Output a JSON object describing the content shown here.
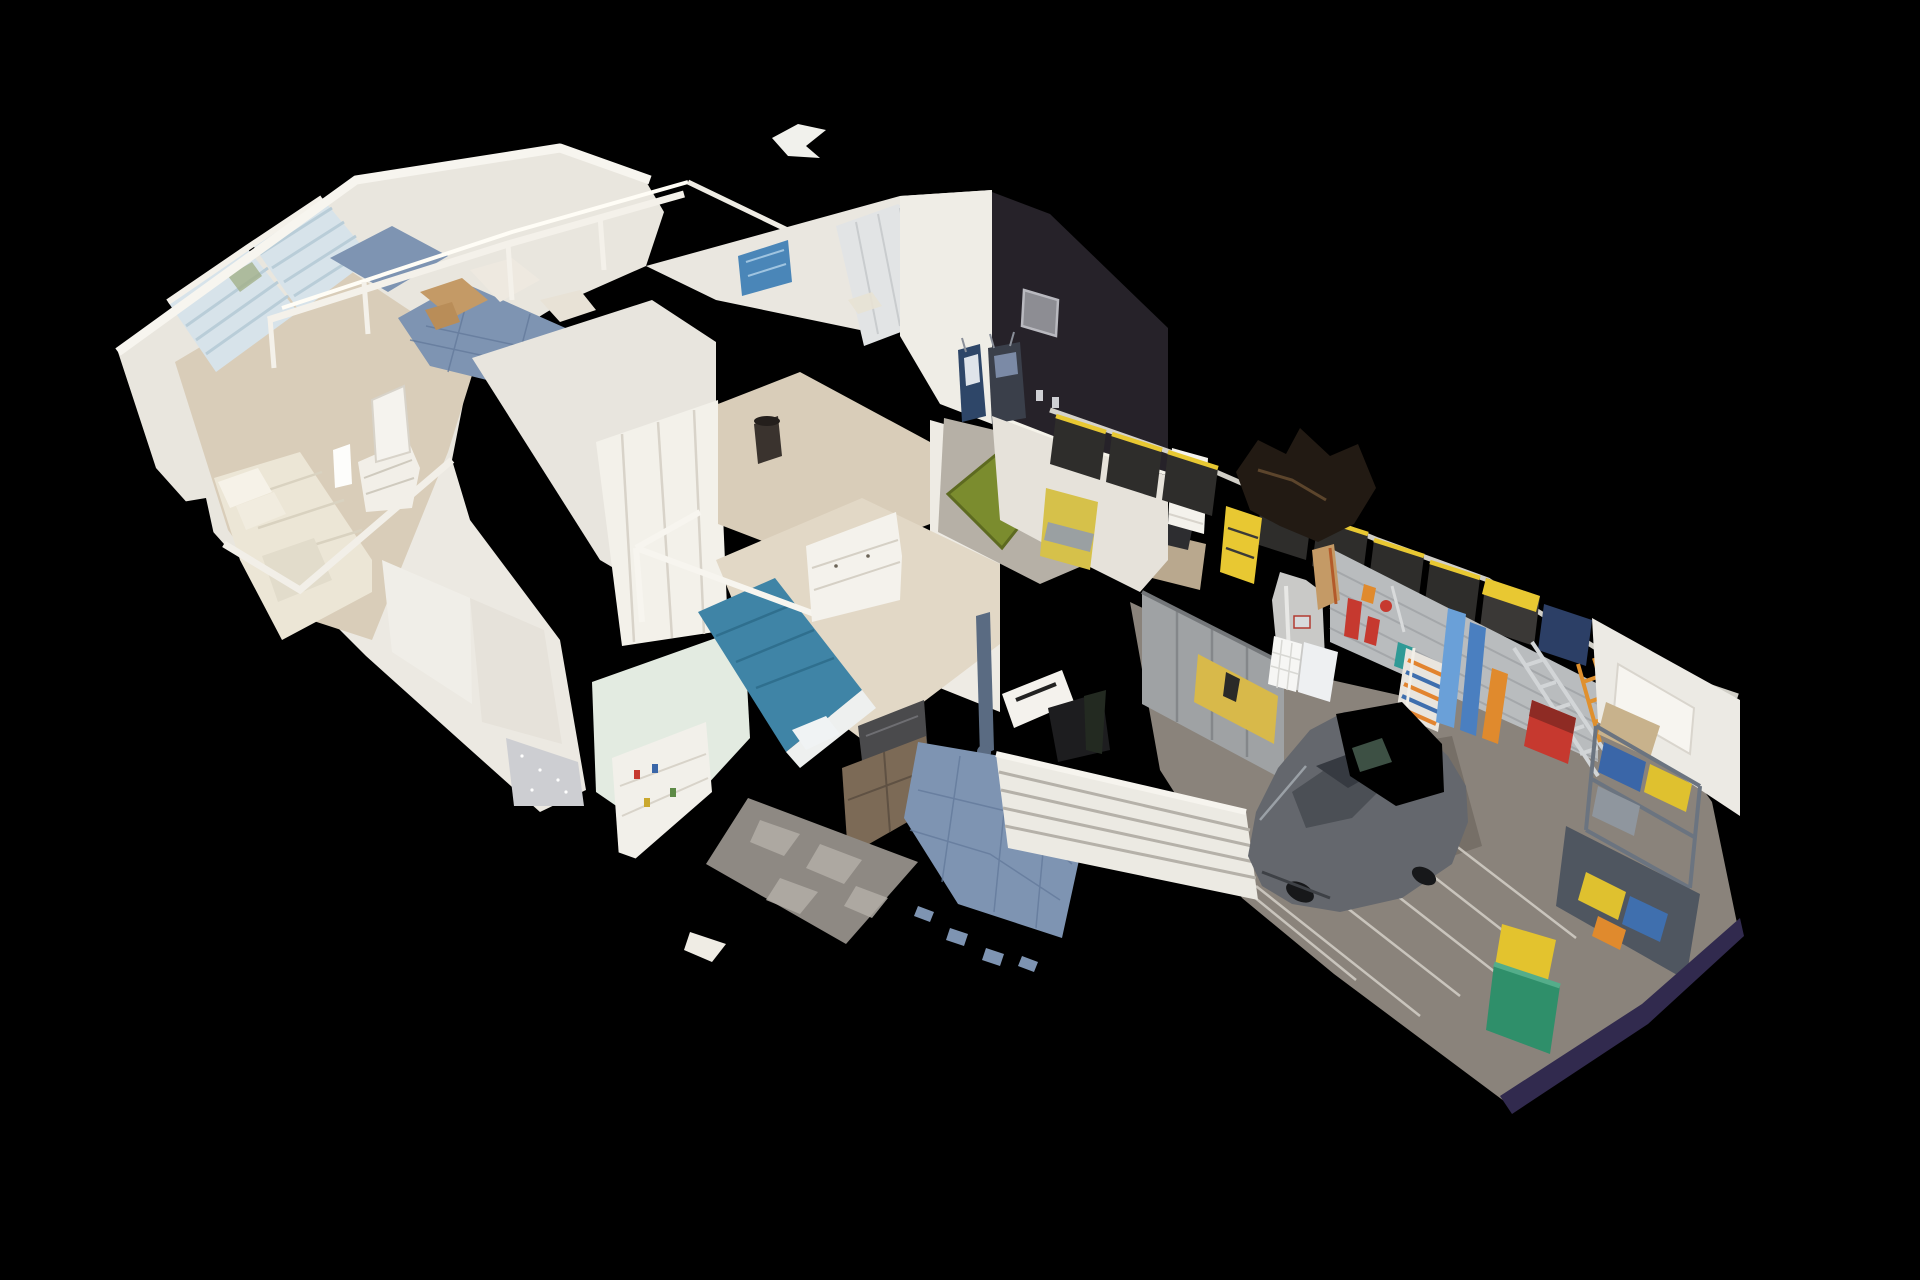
{
  "scene": {
    "app": "3d-home-tour-viewer",
    "view_mode": "dollhouse-cutaway",
    "background": "#000000",
    "description": "Elevated oblique dollhouse view of a scanned single-story home floating on black. Left wing: master bedroom with cream bed, plantation-shutter window wall, white dresser and arched niche. Between wings: blue slate patio with white fence rails and floating scan fragments. Center: tall cut ivory walls, closet doors, hallway with trash can, guest bedroom with teal bed under a white canopy frame, white dresser, TV over a wood cabinet, white bookshelf and mottled grey rug. Upper right: golf room with near-black accent wall, lit picture, two golf bags, grey carpet and green putting mat. Right: garage with grey concrete floor, grey sedan missing its roof (black scan hole), silver cabinets with yellow workbench, water heater, laundry hamper, slat tool wall with red/orange/teal tools, ladders, skis, striped folding chairs, black-and-yellow overhead storage bins, shelving, yellow cart, green trash bin, striped garage-door wall and a dark purple cut edge.",
    "rooms": [
      {
        "name": "master-bedroom",
        "items": [
          "cream bed",
          "plantation shutter windows",
          "white dresser",
          "arched niche",
          "air purifier",
          "wood floor",
          "scan hole"
        ]
      },
      {
        "name": "master-bathroom",
        "items": [
          "blue slate tile strip",
          "glitter tile floor"
        ]
      },
      {
        "name": "patio-courtyard",
        "items": [
          "blue slate tiles",
          "white fence rails",
          "tan scan fragments"
        ]
      },
      {
        "name": "hallway",
        "items": [
          "closet double doors",
          "dark trash can",
          "blue wall art",
          "wood floor"
        ]
      },
      {
        "name": "guest-bedroom",
        "items": [
          "teal bed",
          "white canopy frame",
          "white dresser",
          "tv",
          "wood cabinet",
          "white bookshelf",
          "grey rug",
          "sage cut wall",
          "scan holes"
        ]
      },
      {
        "name": "golf-room",
        "items": [
          "dark accent wall",
          "lit picture frame",
          "outlets",
          "golf bag navy",
          "golf bag black",
          "green putting mat",
          "grey carpet",
          "desk",
          "louvered door",
          "window"
        ]
      },
      {
        "name": "garage",
        "items": [
          "grey sedan",
          "black roof hole",
          "concrete floor",
          "tire streaks",
          "garage door slats",
          "silver cabinets",
          "yellow workbench",
          "water heater",
          "laundry hamper",
          "trash bag",
          "slat tool wall",
          "red tools",
          "teal tools",
          "striped folding chairs",
          "blue boards",
          "orange skis",
          "silver ladder",
          "orange ladder",
          "red generator",
          "overhead black-yellow bins",
          "yellow pressure washer",
          "shop vacuum",
          "ceiling scan blob",
          "electrical door",
          "storage shelving",
          "cardboard boxes",
          "yellow cart",
          "green trash bin",
          "purple cut edge",
          "slate walkway"
        ]
      }
    ],
    "palette": {
      "background": "#000000",
      "wall_ivory": "#e9e6de",
      "wall_bright": "#f7f5ef",
      "wood_floor": "#d9cdb9",
      "wood_floor_light": "#e2d8c6",
      "slate_tile": "#7e94b2",
      "slate_tile_dark": "#5f7894",
      "shutter_blue": "#d7e3ea",
      "cream_bed": "#ece6d6",
      "teal_bed": "#3f84a6",
      "sage_wall": "#e3ebe1",
      "rug_grey": "#8e8983",
      "tv_dark": "#4a4a4c",
      "wood_cabinet": "#7c6a56",
      "dark_accent_wall": "#262229",
      "carpet_grey": "#b6b0a6",
      "putting_green": "#7b8c2e",
      "golf_bag_navy": "#2e4668",
      "garage_floor": "#8a837b",
      "door_slats": "#eceae3",
      "cabinet_grey": "#9fa2a4",
      "workbench_yellow": "#d8b94a",
      "bin_black": "#2e2d2b",
      "bin_yellow": "#e8c832",
      "water_heater": "#c9c9c7",
      "slatwall_grey": "#b9bcbe",
      "tool_red": "#c6392f",
      "tool_orange": "#e08a2d",
      "tool_teal": "#2f9a96",
      "ladder_silver": "#d2d5d7",
      "shelf_blue": "#3a66a8",
      "mower_yellow": "#e3c32e",
      "trash_green": "#2f8f6a",
      "edge_purple": "#312a4e",
      "car_body": "#64676d",
      "car_glass": "#363a41",
      "artifact_tan": "#c49a66"
    }
  }
}
